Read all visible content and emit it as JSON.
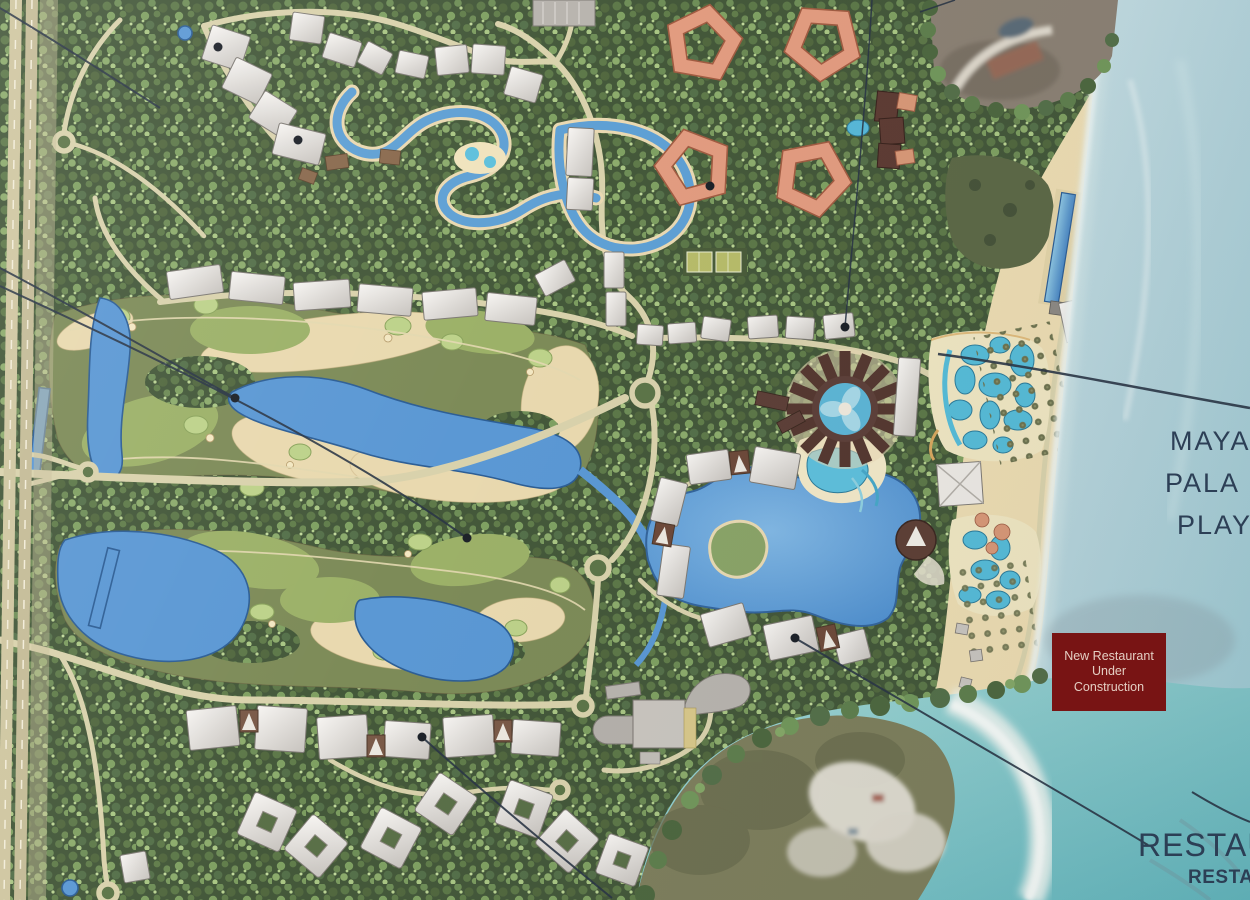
{
  "canvas": {
    "width": 1250,
    "height": 900
  },
  "labels": {
    "resort_name_line1": "MAYA",
    "resort_name_line2": "PALA",
    "resort_name_line3": "PLAY",
    "restaurant_title": "RESTAU",
    "restaurant_subtitle": "RESTAUR",
    "construction_note_line1": "New Restaurant",
    "construction_note_line2": "Under",
    "construction_note_line3": "Construction"
  },
  "colors": {
    "note_background": "#7d1413",
    "note_text": "#eed6ca",
    "map_label_text": "#2e4158",
    "ocean": "#b7d3da",
    "jungle_green": "#46593b",
    "golf_olive": "#7d8b58",
    "sand_tan": "#e9d9af",
    "water_blue": "#5b98d4",
    "pool_cyan": "#5eb6d6",
    "building_gray": "#e6e3df",
    "pentagon_salmon": "#e29c80",
    "dark_maroon_building": "#5a3b31",
    "road_tan": "#d9d2ac",
    "beach_sand": "#e5d3a6",
    "photo_sea_turquoise": "#7cc4c8"
  },
  "features": [
    "jungle-canopy",
    "golf-course",
    "lazy-river",
    "central-lagoon",
    "water-park",
    "beach",
    "ocean",
    "coast-highway",
    "hotel-buildings",
    "pentagon-towers",
    "spa-circle-building",
    "construction-photo-inset",
    "aerial-photo-corner"
  ]
}
